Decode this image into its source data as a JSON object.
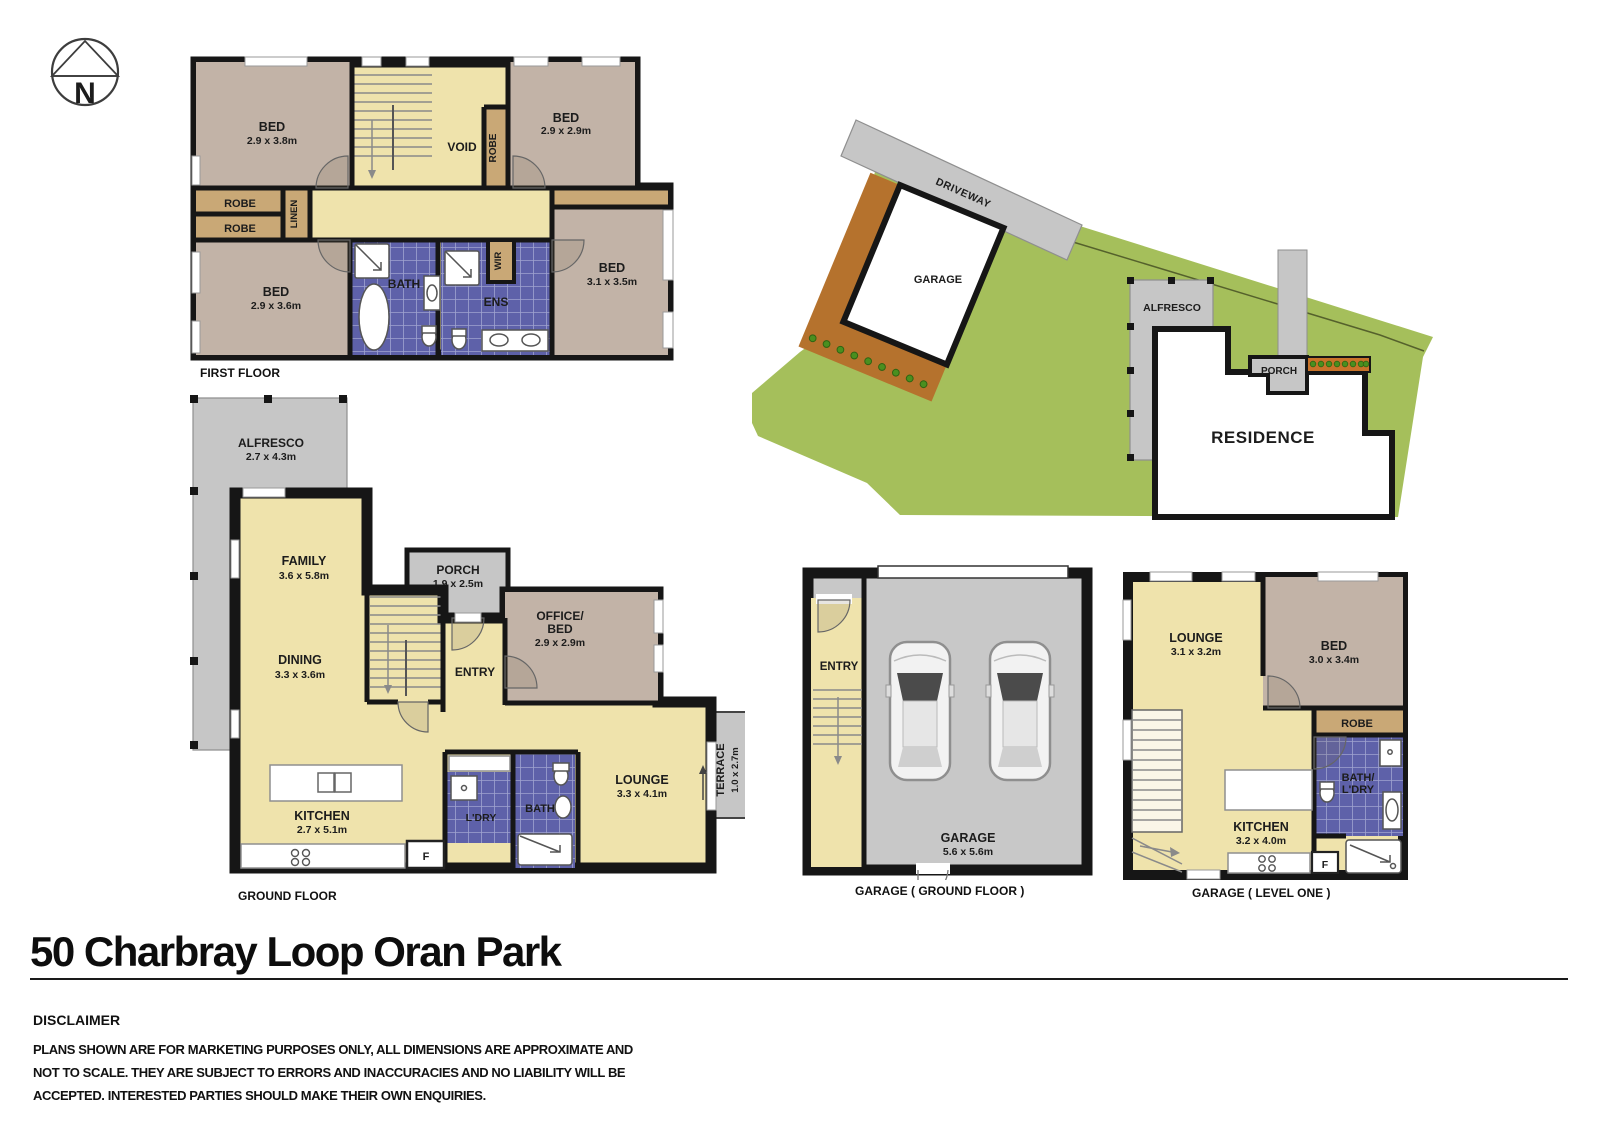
{
  "title": "50 Charbray Loop Oran Park",
  "compass": {
    "letter": "N"
  },
  "colors": {
    "floor_yellow": "#EFE3AC",
    "bed_tan": "#C2B3A7",
    "robe_brown": "#C9A876",
    "tile_blue": "#5E61A9",
    "tile_grout": "#9FA3CF",
    "concrete_gray": "#C6C6C6",
    "grass_green": "#A5BF5B",
    "garden_brown": "#B5722D",
    "planter_orange": "#C8732A",
    "wall_black": "#161616"
  },
  "plans": {
    "first_floor": {
      "label": "FIRST FLOOR",
      "rooms": {
        "bed_tl": {
          "name": "BED",
          "dims": "2.9 x 3.8m"
        },
        "bed_tr": {
          "name": "BED",
          "dims": "2.9 x 2.9m"
        },
        "bed_bl": {
          "name": "BED",
          "dims": "2.9 x 3.6m"
        },
        "bed_r": {
          "name": "BED",
          "dims": "3.1 x 3.5m"
        },
        "void": "VOID",
        "robe_hall": "ROBE",
        "robe1": "ROBE",
        "robe2": "ROBE",
        "linen": "LINEN",
        "bath": "BATH",
        "ens": "ENS",
        "wir": "WIR"
      }
    },
    "ground_floor": {
      "label": "GROUND FLOOR",
      "rooms": {
        "alfresco": {
          "name": "ALFRESCO",
          "dims": "2.7 x 4.3m"
        },
        "family": {
          "name": "FAMILY",
          "dims": "3.6 x 5.8m"
        },
        "dining": {
          "name": "DINING",
          "dims": "3.3 x 3.6m"
        },
        "porch": {
          "name": "PORCH",
          "dims": "1.9 x 2.5m"
        },
        "office": {
          "line1": "OFFICE/",
          "line2": "BED",
          "dims": "2.9 x 2.9m"
        },
        "entry": "ENTRY",
        "kitchen": {
          "name": "KITCHEN",
          "dims": "2.7 x 5.1m"
        },
        "ldry": "L'DRY",
        "bath": "BATH",
        "lounge": {
          "name": "LOUNGE",
          "dims": "3.3 x 4.1m"
        },
        "terrace": {
          "name": "TERRACE",
          "dims": "1.0 x 2.7m"
        },
        "fridge": "F"
      }
    },
    "site": {
      "driveway": "DRIVEWAY",
      "garage": "GARAGE",
      "alfresco": "ALFRESCO",
      "porch": "PORCH",
      "residence": "RESIDENCE"
    },
    "garage_ground": {
      "label": "GARAGE ( GROUND FLOOR )",
      "entry": "ENTRY",
      "garage": {
        "name": "GARAGE",
        "dims": "5.6 x 5.6m"
      }
    },
    "garage_level1": {
      "label": "GARAGE ( LEVEL ONE )",
      "lounge": {
        "name": "LOUNGE",
        "dims": "3.1 x 3.2m"
      },
      "bed": {
        "name": "BED",
        "dims": "3.0 x 3.4m"
      },
      "robe": "ROBE",
      "bath_line1": "BATH/",
      "bath_line2": "L'DRY",
      "kitchen": {
        "name": "KITCHEN",
        "dims": "3.2 x 4.0m"
      },
      "fridge": "F"
    }
  },
  "disclaimer": {
    "heading": "DISCLAIMER",
    "lines": [
      "PLANS SHOWN ARE FOR MARKETING PURPOSES ONLY, ALL DIMENSIONS ARE APPROXIMATE AND",
      "NOT TO SCALE. THEY ARE SUBJECT TO ERRORS AND INACCURACIES AND NO LIABILITY WILL BE",
      "ACCEPTED. INTERESTED PARTIES SHOULD MAKE THEIR OWN ENQUIRIES."
    ]
  }
}
